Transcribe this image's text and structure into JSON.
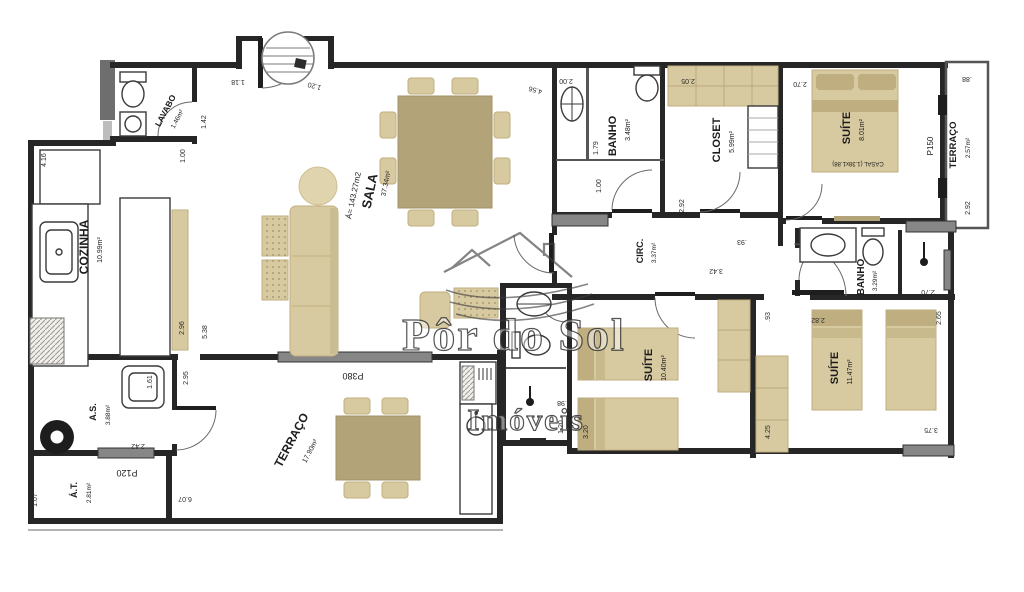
{
  "watermark": {
    "brand": "Pôr do Sol",
    "brand2": "Imóveis"
  },
  "rooms": {
    "cozinha": {
      "n": "COZINHA",
      "a": "10.99m²"
    },
    "sala": {
      "total": "Á= 143.27m2",
      "n": "SALA",
      "a": "37.34m²"
    },
    "lavabo": {
      "n": "LAVABO",
      "a": "1.46m²"
    },
    "banho1": {
      "n": "BANHO",
      "a": "3.48m²"
    },
    "closet": {
      "n": "CLOSET",
      "a": "5.99m²"
    },
    "suite1": {
      "n": "SUÍTE",
      "a": "8.01m²",
      "bed": "CASAL (1.38x1.88)"
    },
    "terraco1": {
      "n": "TERRAÇO",
      "a": "2.57m²"
    },
    "circ": {
      "n": "CIRC.",
      "a": "3.37m²"
    },
    "banho2": {
      "n": "BANHO",
      "a": "3.29m²"
    },
    "suite2": {
      "n": "SUÍTE",
      "a": "10.40m²"
    },
    "suite3": {
      "n": "SUÍTE",
      "a": "11.47m²"
    },
    "as_": {
      "n": "A.S.",
      "a": "3.88m²"
    },
    "at_": {
      "n": "Á.T.",
      "a": "2.81m²"
    },
    "terraco2": {
      "n": "TERRAÇO",
      "a": "17.90m²"
    }
  },
  "doors": {
    "p380": "P380",
    "p150": "P150",
    "p120": "P120"
  },
  "dims": [
    "1.18",
    "1.20",
    "1.42",
    "1.00",
    "4.16",
    "2.96",
    "5.38",
    "4.56",
    "2.00",
    "1.79",
    "1.00",
    "2.05",
    "2.70",
    ".88",
    "2.92",
    "2.92",
    ".93",
    "3.42",
    ".93",
    "2.70",
    "2.82",
    "2.65",
    "3.75",
    "4.25",
    "3.20",
    ".98",
    "1.20",
    "2.95",
    "1.61",
    "2.42",
    "2.42",
    "1.07",
    "6.07"
  ]
}
